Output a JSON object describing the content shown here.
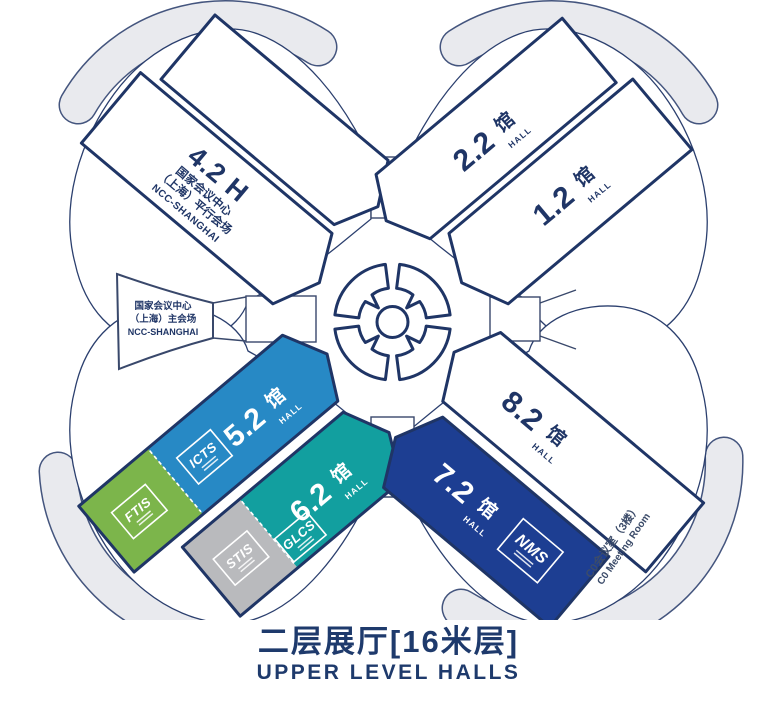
{
  "title": {
    "cn": "二层展厅[16米层]",
    "en": "UPPER LEVEL HALLS"
  },
  "center": {
    "ncc_main": {
      "line1": "国家会议中心",
      "line2": "（上海）主会场",
      "line3": "NCC-SHANGHAI"
    }
  },
  "halls": {
    "h42": {
      "label": "4.2 H",
      "sub1": "国家会议中心",
      "sub2": "（上海）平行会场",
      "sub3": "NCC-SHANGHAI"
    },
    "h22": {
      "num": "2.2",
      "unit": "馆",
      "word": "HALL"
    },
    "h12": {
      "num": "1.2",
      "unit": "馆",
      "word": "HALL"
    },
    "h52": {
      "num": "5.2",
      "unit": "馆",
      "word": "HALL",
      "logo": "ICTS"
    },
    "h62": {
      "num": "6.2",
      "unit": "馆",
      "word": "HALL",
      "logo_gray": "STIS",
      "logo_teal": "GLCS"
    },
    "h72": {
      "num": "7.2",
      "unit": "馆",
      "word": "HALL",
      "logo": "NMS"
    },
    "h82": {
      "num": "8.2",
      "unit": "馆",
      "word": "HALL"
    },
    "ftis": {
      "logo": "FTIS"
    }
  },
  "annex": {
    "c0_cn": "C0会议室（3楼）",
    "c0_en": "C0 Meeting Room"
  },
  "colors": {
    "navy": "#1f3566",
    "blue": "#2789c5",
    "green": "#7cb54b",
    "silver": "#b9babd",
    "teal": "#129f9f",
    "royal": "#1d3e92",
    "band": "#e9eaee",
    "title": "#1e3a6c"
  }
}
